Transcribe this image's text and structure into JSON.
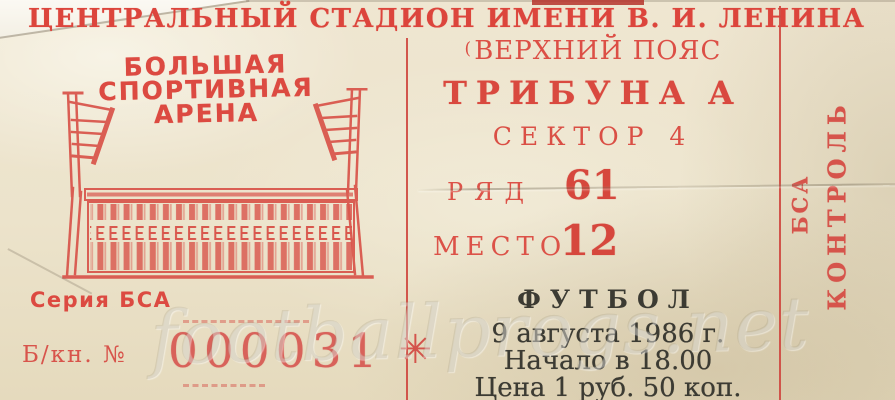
{
  "header": {
    "title": "ЦЕНТРАЛЬНЫЙ СТАДИОН ИМЕНИ В. И. ЛЕНИНА"
  },
  "arena": {
    "line1": "БОЛЬШАЯ",
    "line2": "СПОРТИВНАЯ",
    "line3": "АРЕНА"
  },
  "series": {
    "label": "Серия БСА"
  },
  "booklet": {
    "label": "Б/кн. №",
    "number": "000031",
    "ornament": "✳"
  },
  "seating": {
    "tier_mark": "(",
    "tier": "ВЕРХНИЙ ПОЯС",
    "stand_label": "ТРИБУНА",
    "stand_value": "А",
    "sector_label": "СЕКТОР",
    "sector_value": "4",
    "row_label": "РЯД",
    "row_value": "61",
    "seat_label": "МЕСТО",
    "seat_value": "12"
  },
  "event": {
    "sport": "ФУТБОЛ",
    "date": "9 августа 1986 г.",
    "time": "Начало в 18.00",
    "price": "Цена 1 руб. 50 коп."
  },
  "stub": {
    "series": "БСА",
    "control": "КОНТРОЛЬ"
  },
  "watermark": "footballprogs.net",
  "colors": {
    "ink_red": "#d9534a",
    "ink_red_dark": "#cf4038",
    "ink_dark": "#3c3b33",
    "paper": "#ece3cb"
  }
}
